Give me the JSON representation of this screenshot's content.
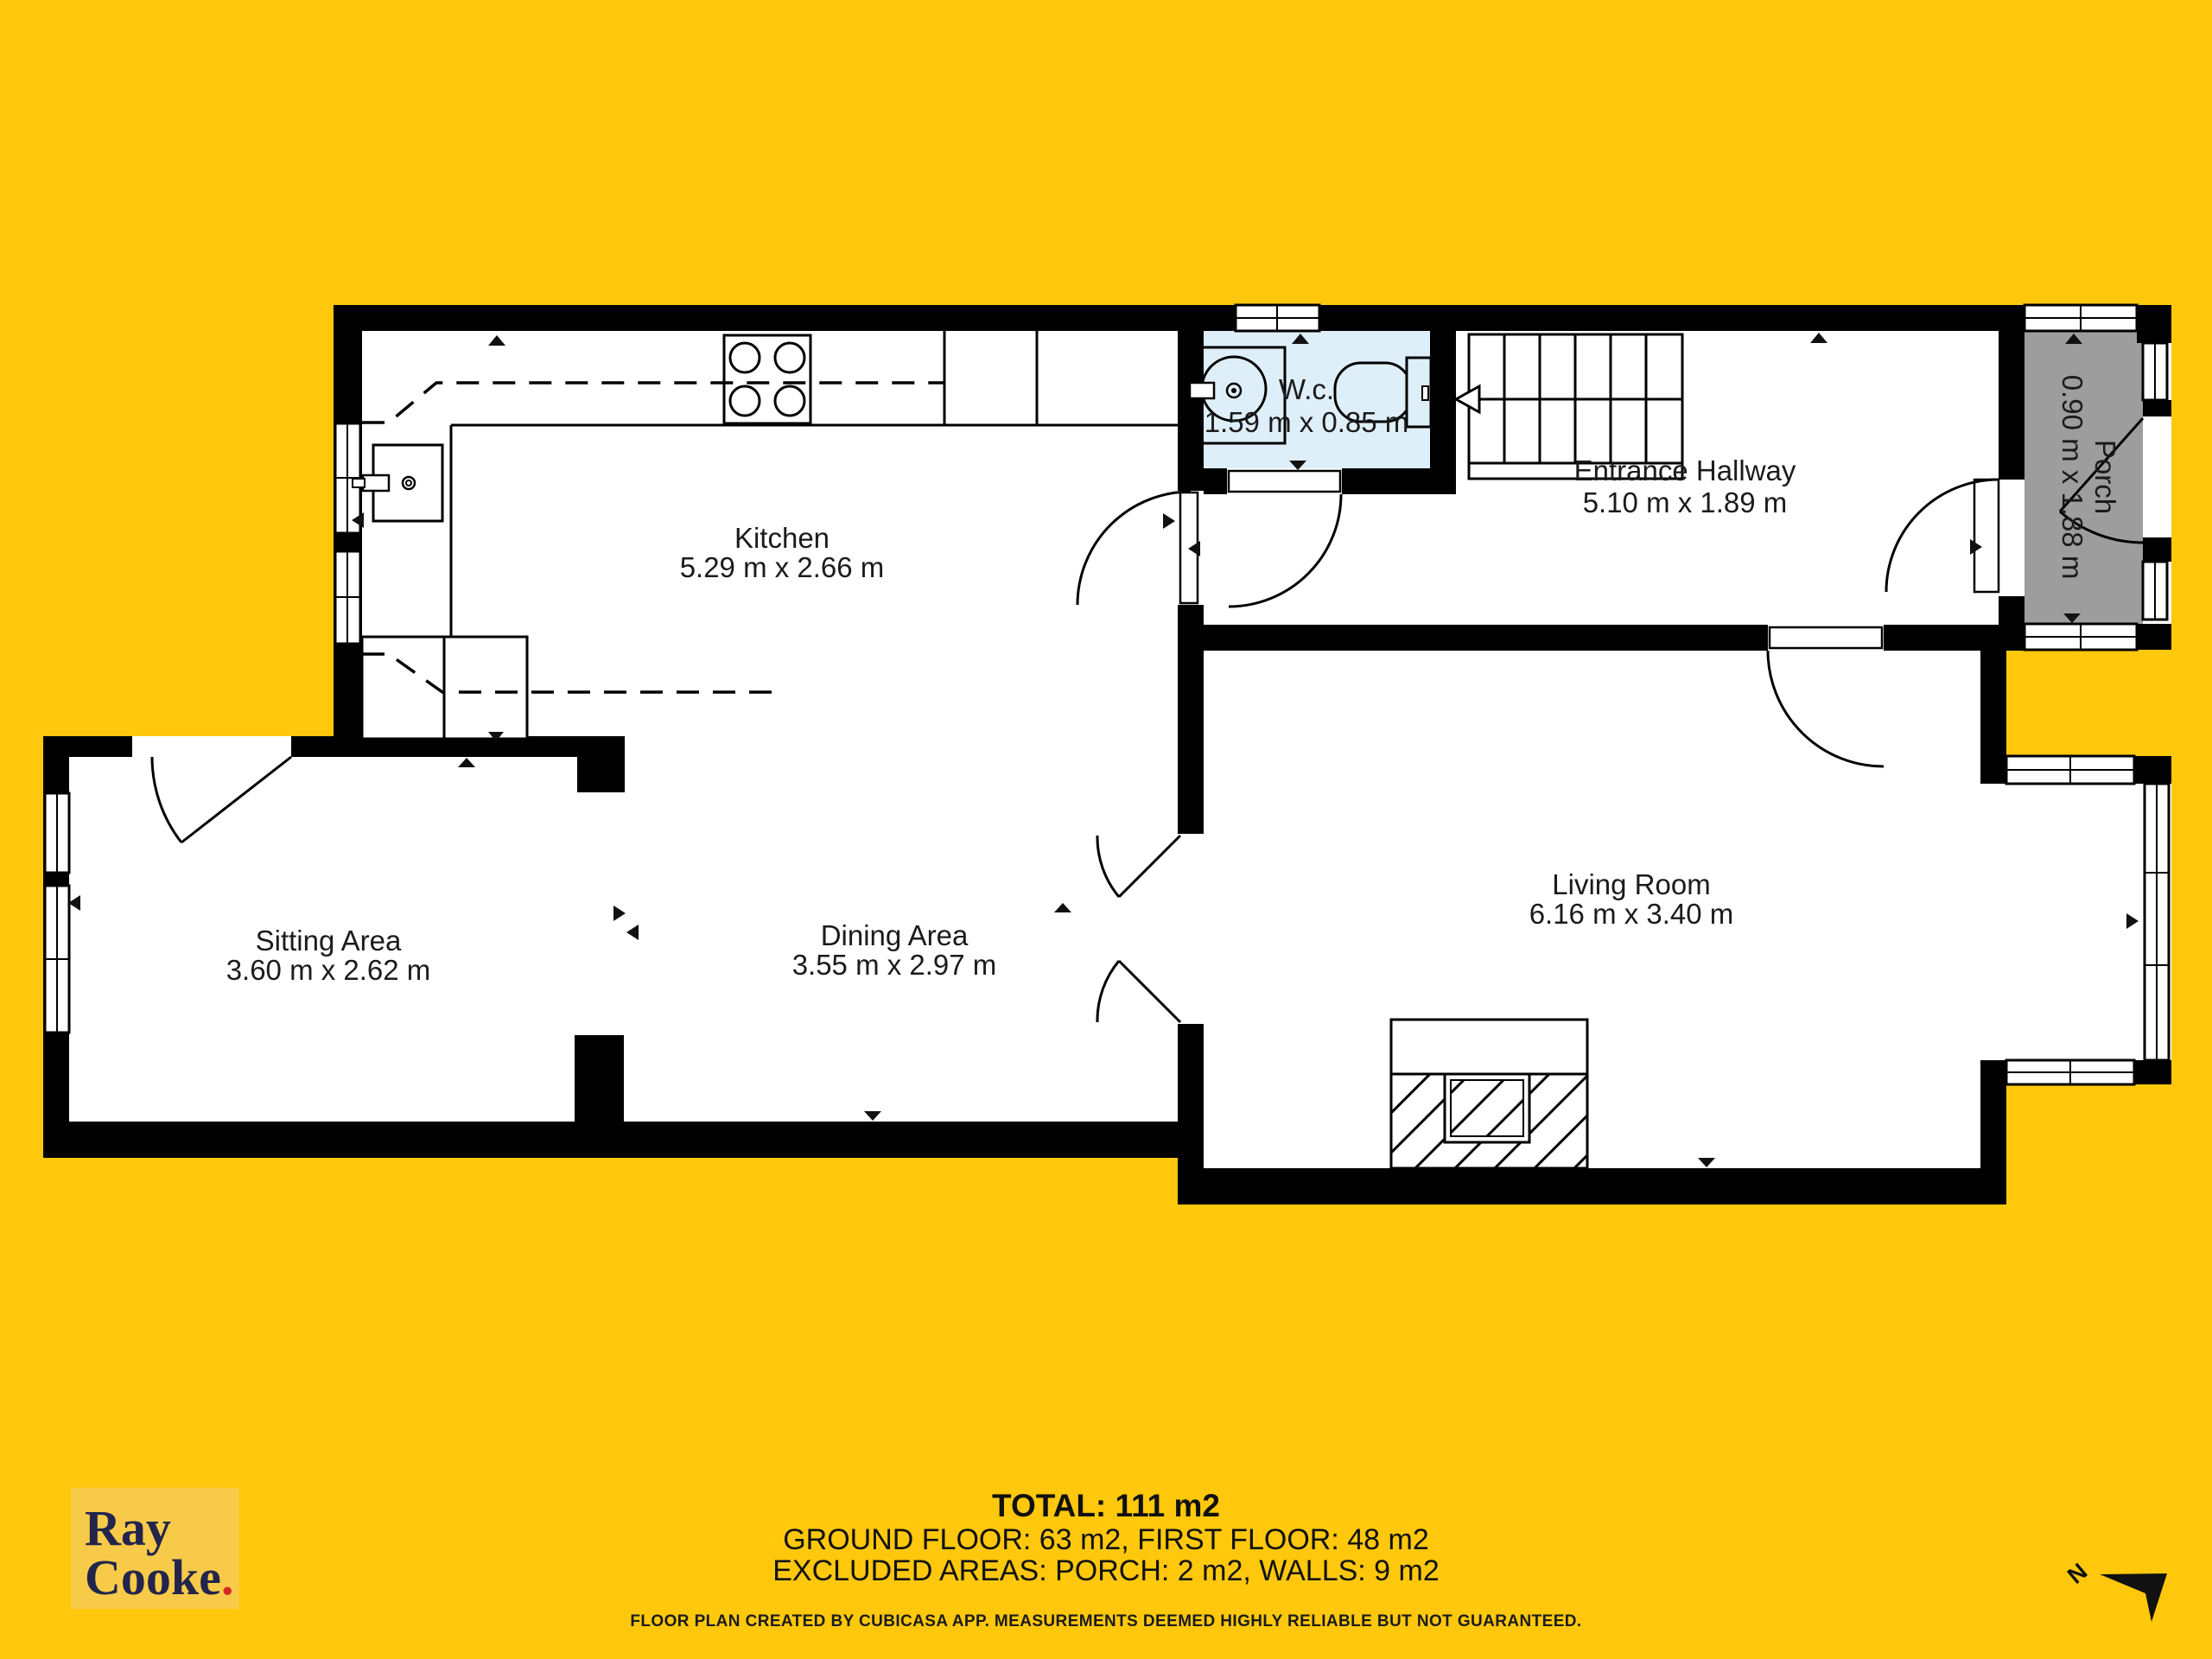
{
  "rooms": {
    "kitchen": {
      "name": "Kitchen",
      "dims": "5.29 m x 2.66 m"
    },
    "wc": {
      "name": "W.c.",
      "dims": "1.59 m x 0.85 m"
    },
    "hallway": {
      "name": "Entrance Hallway",
      "dims": "5.10 m x 1.89 m"
    },
    "porch": {
      "name": "Porch",
      "dims": "0.90 m x 1.88 m"
    },
    "sitting": {
      "name": "Sitting Area",
      "dims": "3.60 m x 2.62 m"
    },
    "dining": {
      "name": "Dining Area",
      "dims": "3.55 m x 2.97 m"
    },
    "living": {
      "name": "Living Room",
      "dims": "6.16 m x 3.40 m"
    }
  },
  "summary": {
    "total": "TOTAL: 111 m2",
    "floors": "GROUND FLOOR: 63 m2, FIRST FLOOR: 48 m2",
    "excluded": "EXCLUDED AREAS: PORCH: 2 m2, WALLS: 9 m2"
  },
  "disclaimer": "FLOOR PLAN CREATED BY CUBICASA APP. MEASUREMENTS DEEMED HIGHLY RELIABLE BUT NOT GUARANTEED.",
  "logo": {
    "line1": "Ray",
    "line2": "Cooke",
    "dot": "."
  },
  "compass": {
    "label": "N"
  },
  "colors": {
    "background": "#FFC80D",
    "logo_panel": "#F7CB49",
    "logo_text": "#23254C",
    "logo_dot": "#D7272E",
    "wall": "#000000",
    "wc_fill": "#DEEFF9",
    "porch_fill": "#9D9D9D",
    "floor": "#FFFFFF"
  }
}
